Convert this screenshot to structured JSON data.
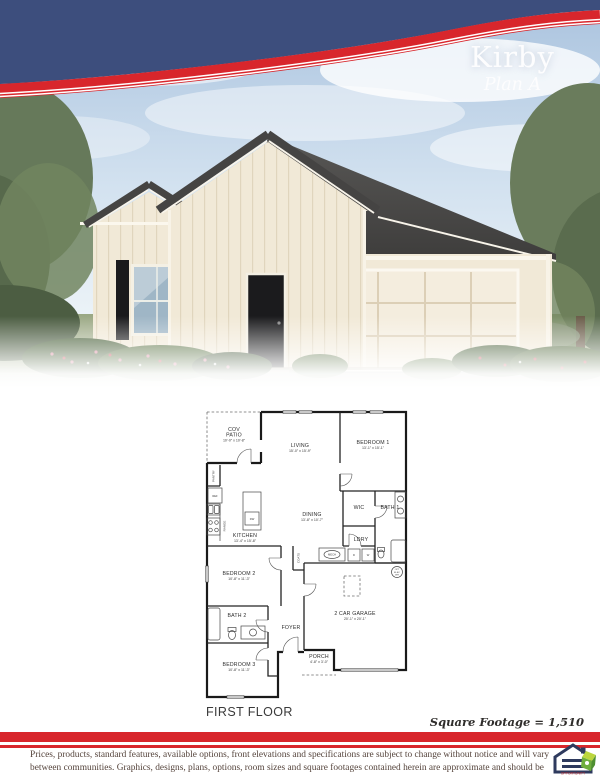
{
  "header": {
    "title": "Kirby",
    "subtitle": "Plan A"
  },
  "colors": {
    "navy": "#3d4e7d",
    "red": "#d8262c",
    "roof": "#4a4a48",
    "wall_cream": "#f1e9d7",
    "sky": "#b5cbe4",
    "lawn": "#95a37d",
    "footer_text": "#55443c"
  },
  "fp": {
    "patio_l1": "COV",
    "patio_l2": "PATIO",
    "patio_dims": "10'-0\" x 10'-8\"",
    "living": "LIVING",
    "living_dims": "15'-0\" x 15'-9\"",
    "bedroom1": "BEDROOM 1",
    "bedroom1_dims": "13'-1\" x 15'-1\"",
    "kitchen": "KITCHEN",
    "kitchen_dims": "13'-4\" x 15'-8\"",
    "dining": "DINING",
    "dining_dims": "13'-8\" x 10'-7\"",
    "bedroom2": "BEDROOM 2",
    "bedroom2_dims": "10'-8\" x 11'-3\"",
    "bedroom3": "BEDROOM 3",
    "bedroom3_dims": "10'-8\" x 11'-3\"",
    "garage": "2 CAR GARAGE",
    "garage_dims": "20'-1\" x 20'-1\"",
    "porch": "PORCH",
    "porch_dims": "4'-8\" x 3'-0\"",
    "wic": "WIC",
    "bath1": "BATH 1",
    "bath2": "BATH 2",
    "ldry": "LDRY",
    "foyer": "FOYER",
    "pantry": "PANTRY",
    "ref": "REF",
    "range": "RANGE",
    "dw": "DW",
    "coats": "COATS",
    "mech": "MECH",
    "dryer": "D",
    "washer": "W",
    "wh_l1": "OPT",
    "wh_l2": "ELEC",
    "wh_l3": "WH",
    "first_floor": "FIRST FLOOR"
  },
  "footer": {
    "square_footage": "Square Footage = 1,510",
    "disclaimer": "Prices, products, standard features, available options, front elevations and specifications are subject to change without notice and will vary between communities.  Graphics, designs, plans, options, room sizes and square footages contained herein are approximate and should be considered estimates only.  Plans are not drawn to scale.",
    "logo_caption": "OPPORTUNITY"
  }
}
